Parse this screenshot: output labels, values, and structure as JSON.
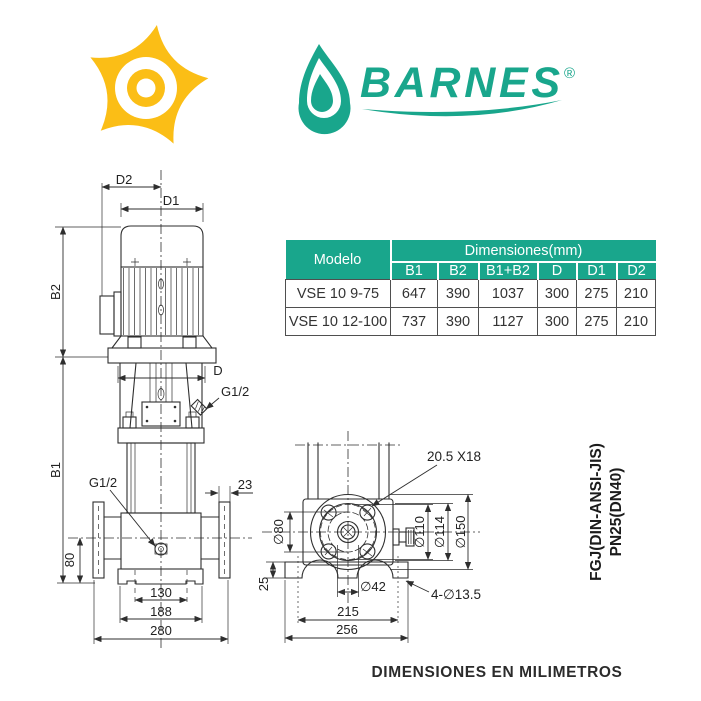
{
  "logo": {
    "brand": "BARNES",
    "registered": "®",
    "impeller_icon": "yellow-impeller",
    "drop_icon": "teal-water-drop"
  },
  "table": {
    "model_header": "Modelo",
    "dimensions_header": "Dimensiones(mm)",
    "columns": [
      "B1",
      "B2",
      "B1+B2",
      "D",
      "D1",
      "D2"
    ],
    "rows": [
      {
        "model": "VSE 10 9-75",
        "values": [
          "647",
          "390",
          "1037",
          "300",
          "275",
          "210"
        ]
      },
      {
        "model": "VSE 10 12-100",
        "values": [
          "737",
          "390",
          "1127",
          "300",
          "275",
          "210"
        ]
      }
    ]
  },
  "front_view": {
    "labels": {
      "d2": "D2",
      "d1": "D1",
      "b2": "B2",
      "b1": "B1",
      "d": "D",
      "g12": "G1/2",
      "flange_thickness": "23",
      "port_height": "80",
      "bolt_spacing": "130",
      "base_width": "188",
      "flange_span": "280"
    }
  },
  "top_view": {
    "labels": {
      "slot": "20.5 X18",
      "hub": "∅80",
      "bolt_circle": "∅110",
      "spigot": "∅114",
      "flange_od": "∅150",
      "shaft": "∅42",
      "holes": "4-∅13.5",
      "plate_thickness": "25",
      "bolt_span": "215",
      "base_length": "256"
    }
  },
  "standard_note": {
    "line1": "FGJ(DIN-ANSI-JIS)",
    "line2": "PN25(DN40)"
  },
  "footer": {
    "caption": "DIMENSIONES EN MILIMETROS"
  },
  "colors": {
    "teal": "#19A68C",
    "yellow": "#FBBE16",
    "line": "#2E2E2E"
  }
}
